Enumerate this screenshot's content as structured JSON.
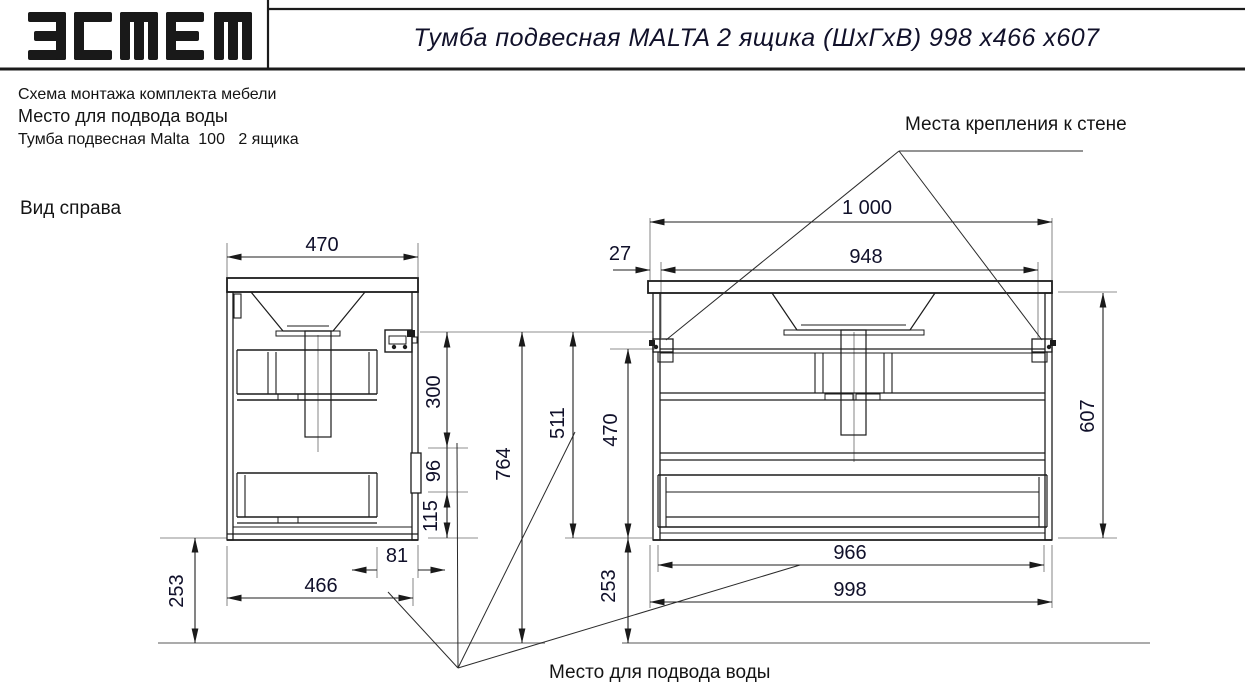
{
  "header": {
    "logo": "эстет",
    "title": "Тумба подвесная MALTA 2 ящика (ШхГхВ) 998 х466 х607"
  },
  "legend": {
    "line1": "Схема монтажа комплекта мебели",
    "line2": "Место для подвода воды",
    "line3": "Тумба подвесная Malta  100   2 ящика"
  },
  "labels": {
    "side_view": "Вид справа",
    "wall_mount": "Места крепления к стене",
    "water_supply": "Место для подвода воды"
  },
  "dims": {
    "side_width": "470",
    "side_h300": "300",
    "side_h96": "96",
    "side_h115": "115",
    "side_off81": "81",
    "side_depth": "466",
    "side_floor": "253",
    "height_total": "764",
    "wall_to_bottom": "511",
    "front_inner_h": "470",
    "front_floor": "253",
    "front_overall": "1 000",
    "front_mount_span": "948",
    "front_edge_offset": "27",
    "front_height": "607",
    "front_inner_w": "966",
    "front_width": "998"
  }
}
